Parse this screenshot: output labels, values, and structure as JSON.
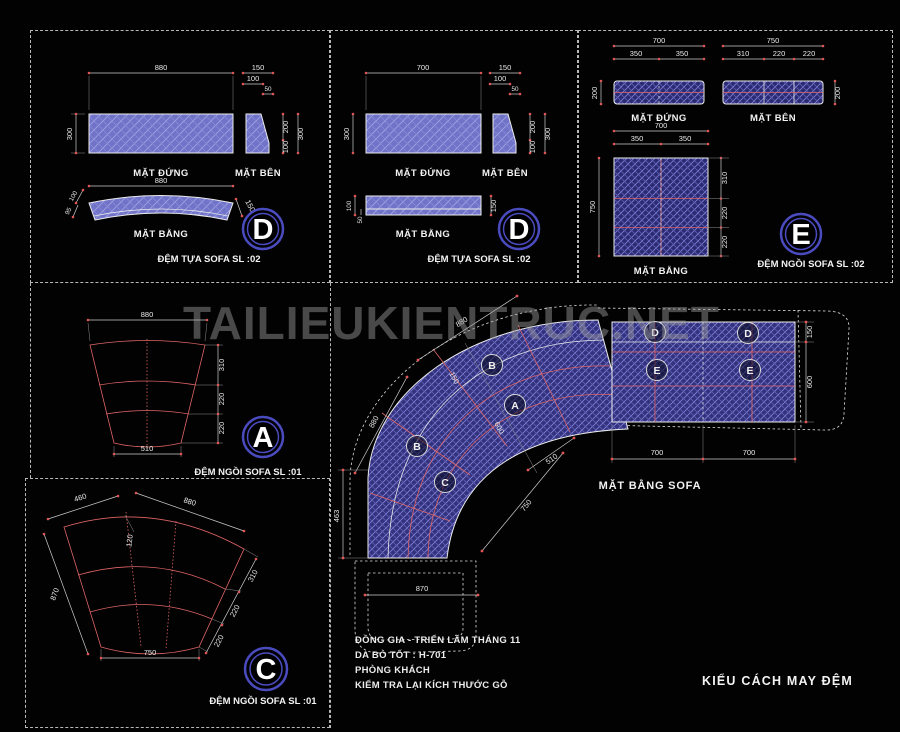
{
  "watermark": "TAILIEUKIENTRUC.NET",
  "colors": {
    "cushion_purple": "#7073c8",
    "hatch_blue": "#8080d8",
    "seam_red": "#e06565",
    "line_white": "#ebebeb",
    "ring_blue": "#4b4bc0"
  },
  "panel_d1": {
    "front_label": "MẶT ĐỨNG",
    "side_label": "MẶT BÊN",
    "plan_label": "MẶT BẰNG",
    "letter": "D",
    "caption": "ĐỆM TỰA SOFA SL :02",
    "d_front_w": "880",
    "d_front_h": "300",
    "d_side_150": "150",
    "d_side_100": "100",
    "d_side_50": "50",
    "d_side_r200": "200",
    "d_side_r100": "100",
    "d_side_r300": "300",
    "d_plan_w": "880",
    "d_plan_100": "100",
    "d_plan_95": "95",
    "d_plan_150": "150"
  },
  "panel_d2": {
    "front_label": "MẶT ĐỨNG",
    "side_label": "MẶT BÊN",
    "plan_label": "MẶT BẰNG",
    "letter": "D",
    "caption": "ĐỆM TỰA SOFA SL :02",
    "d_front_w": "700",
    "d_front_h": "300",
    "d_side_150": "150",
    "d_side_100": "100",
    "d_side_50": "50",
    "d_side_r200": "200",
    "d_side_r100": "100",
    "d_side_r300": "300",
    "d_plan_100": "100",
    "d_plan_50": "50",
    "d_plan_150": "150"
  },
  "panel_e": {
    "front_label": "MẶT ĐỨNG",
    "side_label": "MẶT BÊN",
    "plan_label": "MẶT BẰNG",
    "letter": "E",
    "caption": "ĐỆM NGỒI SOFA SL :02",
    "d_front_w": "700",
    "d_front_350a": "350",
    "d_front_350b": "350",
    "d_front_h": "200",
    "d_side_w": "750",
    "d_side_310": "310",
    "d_side_220a": "220",
    "d_side_220b": "220",
    "d_side_h": "200",
    "d_plan_w": "700",
    "d_plan_350a": "350",
    "d_plan_350b": "350",
    "d_plan_h": "750",
    "d_plan_310": "310",
    "d_plan_220a": "220",
    "d_plan_220b": "220"
  },
  "panel_a": {
    "letter": "A",
    "caption": "ĐỆM NGỒI SOFA SL :01",
    "d_top": "880",
    "d_bottom": "510",
    "d_310": "310",
    "d_220a": "220",
    "d_220b": "220"
  },
  "panel_c": {
    "letter": "C",
    "caption": "ĐỆM NGỒI SOFA SL :01",
    "d_460": "460",
    "d_880": "880",
    "d_120": "120",
    "d_870": "870",
    "d_310": "310",
    "d_220a": "220",
    "d_220b": "220",
    "d_750": "750"
  },
  "plan": {
    "title": "MẶT BẰNG SOFA",
    "mark_b1": "B",
    "mark_a": "A",
    "mark_b2": "B",
    "mark_c": "C",
    "mark_d1": "D",
    "mark_d2": "D",
    "mark_e1": "E",
    "mark_e2": "E",
    "d_back_top": "880",
    "d_back_left": "880",
    "d_150": "150",
    "d_600": "600",
    "d_510": "510",
    "d_463": "463",
    "d_870": "870",
    "d_750": "750",
    "d_700a": "700",
    "d_700b": "700",
    "d_r150": "150",
    "d_r600": "600"
  },
  "notes": {
    "line1": "ĐỒNG GIA - TRIỂN LÃM THÁNG 11",
    "line2": "DA BÒ TỐT : H-701",
    "line3": "PHÒNG KHÁCH",
    "line4": "KIỂM TRA LẠI KÍCH THƯỚC GỖ"
  },
  "footer_title": "KIỂU CÁCH MAY ĐỆM"
}
